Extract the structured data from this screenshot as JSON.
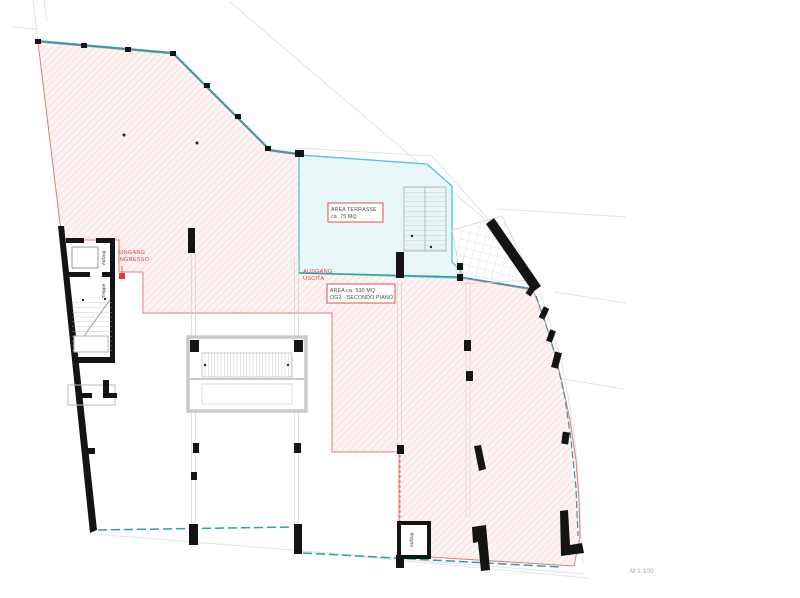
{
  "drawing": {
    "type": "architectural floor plan",
    "scale_label": "M 1:100"
  },
  "area_boxes": {
    "terrace": {
      "line1": "AREA  TERRASSE",
      "line2": "ca. 75 MQ"
    },
    "floor": {
      "line1": "AREA  ca. 530 MQ",
      "line2": "OG2 -  SECONDO PIANO"
    }
  },
  "annotations": {
    "entrance": {
      "line1": "EINGANG",
      "line2": "INGRESSO"
    },
    "exit": {
      "line1": "AUSGANG",
      "line2": "USCITA"
    },
    "elevator_upper": "Aufzug",
    "stair_upper": "Treppe",
    "elevator_lower": "Aufzug"
  },
  "colors": {
    "boundary_red": "#e87a7a",
    "hatch_red": "#f1c2c2",
    "hatch_bg": "#fdf3f3",
    "terrace_fill": "#e9f6f8",
    "terrace_border": "#58c6d6",
    "teal_edge": "#2f9fa8",
    "wall_black": "#141414",
    "construction_gray": "#e0e0e0",
    "stair_gray": "#c6c6c6",
    "annotation_red": "#e03c3c",
    "scale_gray": "#a9a9a9"
  }
}
